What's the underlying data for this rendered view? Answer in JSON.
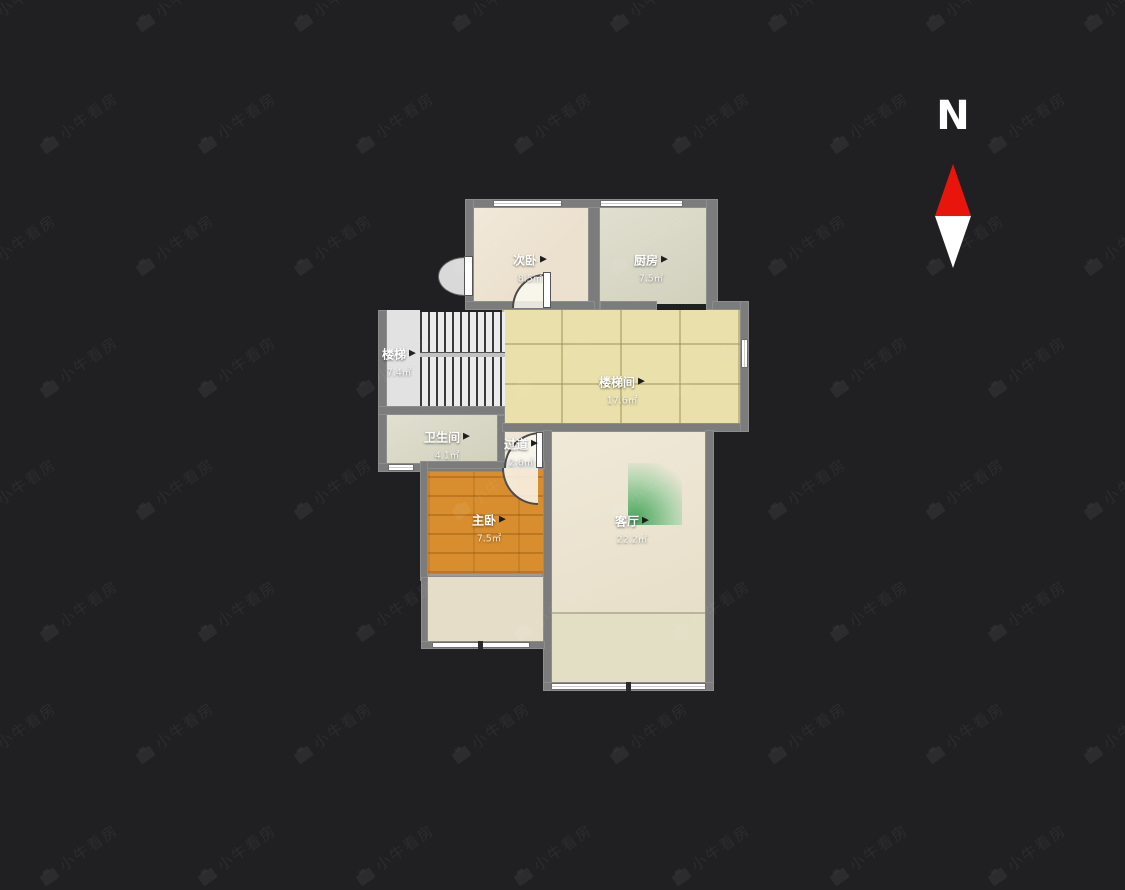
{
  "app": {
    "watermark_text": "小牛看房",
    "watermark_icon": "camera-icon"
  },
  "compass": {
    "label": "N",
    "north_color": "#e8150d",
    "south_color": "#ffffff"
  },
  "colors": {
    "background": "#202022",
    "wall": "#7c7c7c",
    "bedroom_floor": "#ece1ce",
    "kitchen_bath_floor": "#d8d7c3",
    "tile_floor": "#e9e0ab",
    "wood_floor": "#d88e2f",
    "light_fan_green": "#3fae57"
  },
  "rooms": [
    {
      "id": "secondary-bedroom",
      "label": "次卧",
      "area": "8.5㎡"
    },
    {
      "id": "kitchen",
      "label": "厨房",
      "area": "7.5㎡"
    },
    {
      "id": "stairs",
      "label": "楼梯",
      "area": "7.4㎡"
    },
    {
      "id": "stairwell",
      "label": "楼梯间",
      "area": "17.6㎡"
    },
    {
      "id": "bathroom",
      "label": "卫生间",
      "area": "4.1㎡"
    },
    {
      "id": "hallway",
      "label": "过道",
      "area": "2.6㎡"
    },
    {
      "id": "master-bedroom",
      "label": "主卧",
      "area": "7.5㎡"
    },
    {
      "id": "living-room",
      "label": "客厅",
      "area": "22.2㎡"
    }
  ],
  "icons": {
    "room_pointer": "▶"
  }
}
